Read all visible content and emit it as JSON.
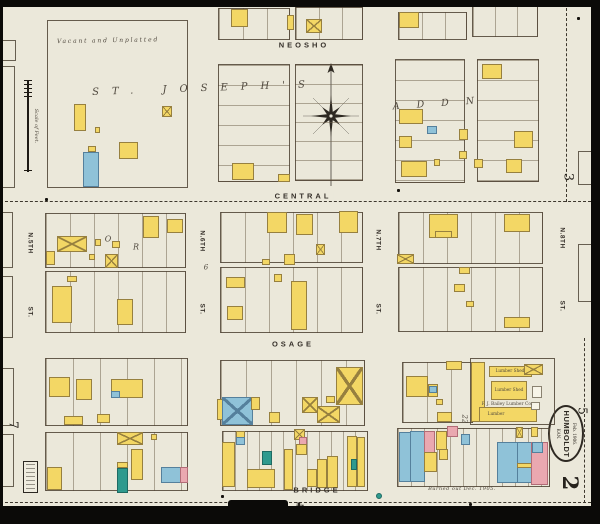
{
  "map": {
    "colors": {
      "paper": "#ebe8da",
      "block_line": "#4e4232",
      "yellow": "#f3d765",
      "yellow_line": "#97803f",
      "blue": "#8fc2d8",
      "blue_line": "#55809c",
      "teal": "#2f9a8e",
      "teal_line": "#1e6b63",
      "pink": "#eaa8b0",
      "pink_line": "#b26c77",
      "white": "#f7f4e8",
      "white_line": "#8a8271",
      "ink": "#36302a"
    },
    "stamp": {
      "date": "Feb. 1906.",
      "city": "HUMBOLDT",
      "state": "KAN."
    },
    "scale_label": "Scale of Feet.",
    "street_labels": [
      {
        "t": "NEOSHO",
        "x": 304,
        "y": 46,
        "r": 0,
        "s": 7.5,
        "ls": 3
      },
      {
        "t": "CENTRAL",
        "x": 303,
        "y": 197,
        "r": 0,
        "s": 7.5,
        "ls": 3,
        "bg": 1
      },
      {
        "t": "OSAGE",
        "x": 293,
        "y": 345,
        "r": 0,
        "s": 7.5,
        "ls": 3
      },
      {
        "t": "BRIDGE",
        "x": 317,
        "y": 491,
        "r": 0,
        "s": 7.5,
        "ls": 3
      },
      {
        "t": "N.5TH",
        "x": 30,
        "y": 243,
        "r": 90,
        "s": 6.5,
        "ls": 0.5
      },
      {
        "t": "ST.",
        "x": 30,
        "y": 312,
        "r": 90,
        "s": 6.5,
        "ls": 0.5
      },
      {
        "t": "N.6TH",
        "x": 202,
        "y": 241,
        "r": 90,
        "s": 6.5,
        "ls": 0.5
      },
      {
        "t": "ST.",
        "x": 202,
        "y": 309,
        "r": 90,
        "s": 6.5,
        "ls": 0.5
      },
      {
        "t": "N.7TH",
        "x": 378,
        "y": 240,
        "r": 90,
        "s": 6.5,
        "ls": 0.5
      },
      {
        "t": "ST.",
        "x": 378,
        "y": 309,
        "r": 90,
        "s": 6.5,
        "ls": 0.5
      },
      {
        "t": "N.8TH",
        "x": 562,
        "y": 238,
        "r": 90,
        "s": 6.5,
        "ls": 0.5
      },
      {
        "t": "ST.",
        "x": 562,
        "y": 306,
        "r": 90,
        "s": 6.5,
        "ls": 0.5
      }
    ],
    "annotations": [
      {
        "t": "Vacant and Unplatted",
        "x": 108,
        "y": 41,
        "r": -1,
        "s": 6,
        "ls": 1.8,
        "i": 1
      },
      {
        "t": "ST. JOSEPH'S",
        "x": 205,
        "y": 89,
        "r": -2,
        "s": 10,
        "ls": 13,
        "i": 1
      },
      {
        "t": "ADDN",
        "x": 442,
        "y": 104,
        "r": -4,
        "s": 9.5,
        "ls": 17,
        "i": 1
      },
      {
        "t": "O",
        "x": 108,
        "y": 240,
        "r": 0,
        "s": 8,
        "ls": 0,
        "i": 1
      },
      {
        "t": "R",
        "x": 136,
        "y": 248,
        "r": 0,
        "s": 8,
        "ls": 0,
        "i": 1
      },
      {
        "t": "6",
        "x": 206,
        "y": 268,
        "r": 0,
        "s": 7,
        "ls": 0,
        "i": 1
      },
      {
        "t": "Lumber Shed",
        "x": 510,
        "y": 371,
        "r": 0,
        "s": 4.2,
        "ls": 0,
        "i": 0
      },
      {
        "t": "Lumber Shed",
        "x": 509,
        "y": 390,
        "r": 0,
        "s": 4.2,
        "ls": 0,
        "i": 0
      },
      {
        "t": "F. J. Bailey Lumber Co.",
        "x": 507,
        "y": 404,
        "r": 0,
        "s": 4.4,
        "ls": 0,
        "i": 0
      },
      {
        "t": "Lumber",
        "x": 496,
        "y": 414,
        "r": 0,
        "s": 4.2,
        "ls": 0,
        "i": 0
      },
      {
        "t": "Burned out Dec. 1905.",
        "x": 462,
        "y": 489,
        "r": 0,
        "s": 5,
        "ls": 0.5,
        "i": 1
      },
      {
        "t": "22",
        "x": 464,
        "y": 419,
        "r": 90,
        "s": 7,
        "ls": 0,
        "i": 1
      }
    ],
    "page_numbers": [
      {
        "t": "3",
        "x": 567,
        "y": 177,
        "r": 90,
        "s": 13,
        "b": 0
      },
      {
        "t": "5",
        "x": 581,
        "y": 411,
        "r": 90,
        "s": 12,
        "b": 0
      },
      {
        "t": "7",
        "x": 12,
        "y": 425,
        "r": 90,
        "s": 12,
        "b": 0
      },
      {
        "t": "2",
        "x": 567,
        "y": 483,
        "r": 90,
        "s": 21,
        "b": 1
      },
      {
        "t": "4",
        "x": 300,
        "y": 505,
        "r": 180,
        "s": 12,
        "b": 1
      }
    ],
    "blocks": [
      [
        47,
        20,
        141,
        168,
        "",
        0
      ],
      [
        218,
        8,
        72,
        32,
        "v",
        24
      ],
      [
        295,
        7,
        68,
        33,
        "v",
        23
      ],
      [
        398,
        12,
        69,
        28,
        "v",
        23
      ],
      [
        472,
        6,
        66,
        31,
        "v",
        22
      ],
      [
        218,
        64,
        72,
        118,
        "h",
        20
      ],
      [
        295,
        64,
        68,
        117,
        "h",
        19
      ],
      [
        395,
        59,
        70,
        124,
        "h",
        20
      ],
      [
        477,
        59,
        62,
        123,
        "h",
        20
      ],
      [
        45,
        213,
        141,
        55,
        "v",
        24
      ],
      [
        45,
        271,
        141,
        62,
        "v",
        24
      ],
      [
        220,
        212,
        143,
        51,
        "v",
        24
      ],
      [
        220,
        267,
        143,
        66,
        "v",
        24
      ],
      [
        398,
        212,
        145,
        52,
        "v",
        24
      ],
      [
        398,
        267,
        145,
        65,
        "v",
        24
      ],
      [
        45,
        358,
        143,
        68,
        "v",
        27
      ],
      [
        45,
        432,
        143,
        59,
        "v",
        27
      ],
      [
        220,
        360,
        145,
        66,
        "v",
        25
      ],
      [
        222,
        431,
        146,
        60,
        "v",
        12
      ],
      [
        402,
        362,
        71,
        61,
        "v",
        24
      ],
      [
        470,
        358,
        85,
        67,
        "",
        0
      ],
      [
        397,
        428,
        153,
        59,
        "v",
        13
      ]
    ],
    "buildings": [
      [
        74,
        104,
        12,
        27,
        "y"
      ],
      [
        88,
        146,
        8,
        6,
        "y"
      ],
      [
        83,
        152,
        16,
        35,
        "b"
      ],
      [
        119,
        142,
        19,
        17,
        "y"
      ],
      [
        162,
        106,
        10,
        11,
        "y",
        "x"
      ],
      [
        95,
        127,
        5,
        6,
        "y"
      ],
      [
        231,
        9,
        17,
        18,
        "y"
      ],
      [
        287,
        15,
        7,
        15,
        "y"
      ],
      [
        306,
        19,
        16,
        14,
        "y",
        "x"
      ],
      [
        399,
        12,
        20,
        16,
        "y"
      ],
      [
        442,
        1,
        11,
        6,
        "y"
      ],
      [
        514,
        0,
        13,
        5,
        "y"
      ],
      [
        232,
        163,
        22,
        17,
        "y"
      ],
      [
        278,
        174,
        12,
        8,
        "y"
      ],
      [
        482,
        64,
        20,
        15,
        "y"
      ],
      [
        399,
        109,
        24,
        15,
        "y"
      ],
      [
        427,
        126,
        10,
        8,
        "b"
      ],
      [
        459,
        129,
        9,
        11,
        "y"
      ],
      [
        399,
        136,
        13,
        12,
        "y"
      ],
      [
        514,
        131,
        19,
        17,
        "y"
      ],
      [
        401,
        161,
        26,
        16,
        "y"
      ],
      [
        506,
        159,
        16,
        14,
        "y"
      ],
      [
        459,
        151,
        8,
        8,
        "y"
      ],
      [
        474,
        159,
        9,
        9,
        "y"
      ],
      [
        434,
        159,
        6,
        7,
        "y"
      ],
      [
        57,
        236,
        30,
        16,
        "y",
        "x"
      ],
      [
        46,
        251,
        9,
        14,
        "y"
      ],
      [
        95,
        239,
        6,
        7,
        "y"
      ],
      [
        112,
        241,
        8,
        7,
        "y"
      ],
      [
        105,
        254,
        13,
        14,
        "y",
        "x"
      ],
      [
        89,
        254,
        6,
        6,
        "y"
      ],
      [
        143,
        216,
        16,
        22,
        "y"
      ],
      [
        167,
        219,
        16,
        14,
        "y"
      ],
      [
        67,
        276,
        10,
        6,
        "y"
      ],
      [
        52,
        286,
        20,
        37,
        "y"
      ],
      [
        117,
        299,
        16,
        26,
        "y"
      ],
      [
        267,
        212,
        20,
        21,
        "y"
      ],
      [
        296,
        214,
        17,
        21,
        "y"
      ],
      [
        339,
        211,
        19,
        22,
        "y"
      ],
      [
        316,
        244,
        9,
        11,
        "y",
        "x"
      ],
      [
        284,
        254,
        11,
        11,
        "y"
      ],
      [
        262,
        259,
        8,
        6,
        "y"
      ],
      [
        226,
        277,
        19,
        11,
        "y"
      ],
      [
        227,
        306,
        16,
        14,
        "y"
      ],
      [
        291,
        281,
        16,
        49,
        "y"
      ],
      [
        274,
        274,
        8,
        8,
        "y"
      ],
      [
        429,
        214,
        29,
        24,
        "y"
      ],
      [
        504,
        214,
        26,
        18,
        "y"
      ],
      [
        397,
        254,
        17,
        10,
        "y",
        "x"
      ],
      [
        435,
        231,
        17,
        7,
        "y"
      ],
      [
        459,
        267,
        11,
        7,
        "y"
      ],
      [
        454,
        284,
        11,
        8,
        "y"
      ],
      [
        504,
        317,
        26,
        11,
        "y"
      ],
      [
        466,
        301,
        8,
        6,
        "y"
      ],
      [
        49,
        377,
        21,
        20,
        "y"
      ],
      [
        76,
        379,
        16,
        21,
        "y"
      ],
      [
        111,
        379,
        32,
        19,
        "y"
      ],
      [
        111,
        391,
        9,
        7,
        "b"
      ],
      [
        64,
        416,
        19,
        9,
        "y"
      ],
      [
        97,
        414,
        13,
        9,
        "y"
      ],
      [
        117,
        432,
        26,
        13,
        "y",
        "x"
      ],
      [
        151,
        434,
        6,
        6,
        "y"
      ],
      [
        47,
        467,
        15,
        23,
        "y"
      ],
      [
        117,
        462,
        11,
        6,
        "y"
      ],
      [
        117,
        468,
        11,
        25,
        "t"
      ],
      [
        131,
        449,
        12,
        31,
        "y"
      ],
      [
        161,
        467,
        27,
        16,
        "b"
      ],
      [
        180,
        467,
        8,
        16,
        "p"
      ],
      [
        217,
        399,
        8,
        21,
        "y"
      ],
      [
        222,
        397,
        31,
        28,
        "b",
        "x"
      ],
      [
        251,
        397,
        9,
        13,
        "y"
      ],
      [
        269,
        412,
        11,
        11,
        "y"
      ],
      [
        302,
        397,
        16,
        16,
        "y",
        "x"
      ],
      [
        317,
        406,
        23,
        17,
        "y",
        "x"
      ],
      [
        336,
        367,
        27,
        38,
        "y",
        "x"
      ],
      [
        326,
        396,
        9,
        7,
        "y"
      ],
      [
        222,
        442,
        13,
        45,
        "y"
      ],
      [
        236,
        431,
        9,
        7,
        "y"
      ],
      [
        236,
        437,
        9,
        8,
        "b"
      ],
      [
        247,
        469,
        28,
        19,
        "y"
      ],
      [
        262,
        451,
        10,
        14,
        "t"
      ],
      [
        284,
        449,
        9,
        41,
        "y"
      ],
      [
        294,
        429,
        11,
        11,
        "y",
        "x"
      ],
      [
        299,
        437,
        8,
        10,
        "p"
      ],
      [
        296,
        444,
        11,
        11,
        "y"
      ],
      [
        307,
        469,
        10,
        18,
        "y"
      ],
      [
        317,
        459,
        10,
        29,
        "y"
      ],
      [
        327,
        456,
        11,
        32,
        "y"
      ],
      [
        347,
        436,
        10,
        51,
        "y"
      ],
      [
        351,
        459,
        6,
        11,
        "t"
      ],
      [
        357,
        437,
        8,
        50,
        "y"
      ],
      [
        406,
        376,
        22,
        21,
        "y"
      ],
      [
        428,
        384,
        10,
        13,
        "y"
      ],
      [
        429,
        386,
        8,
        7,
        "b"
      ],
      [
        436,
        399,
        7,
        6,
        "y"
      ],
      [
        437,
        412,
        15,
        10,
        "y"
      ],
      [
        446,
        361,
        16,
        9,
        "y"
      ],
      [
        471,
        362,
        14,
        60,
        "y"
      ],
      [
        489,
        366,
        43,
        11,
        "y"
      ],
      [
        524,
        364,
        19,
        11,
        "y",
        "x"
      ],
      [
        491,
        381,
        36,
        19,
        "y"
      ],
      [
        532,
        386,
        10,
        12,
        "w"
      ],
      [
        479,
        407,
        58,
        15,
        "y"
      ],
      [
        531,
        402,
        9,
        8,
        "w"
      ],
      [
        399,
        432,
        12,
        50,
        "b"
      ],
      [
        410,
        431,
        15,
        51,
        "b"
      ],
      [
        424,
        431,
        11,
        22,
        "p"
      ],
      [
        424,
        452,
        13,
        20,
        "y"
      ],
      [
        436,
        431,
        11,
        19,
        "y"
      ],
      [
        447,
        426,
        11,
        11,
        "p"
      ],
      [
        461,
        434,
        9,
        11,
        "b"
      ],
      [
        439,
        449,
        9,
        11,
        "y"
      ],
      [
        497,
        442,
        21,
        41,
        "b"
      ],
      [
        517,
        442,
        15,
        41,
        "b"
      ],
      [
        517,
        463,
        15,
        5,
        "y"
      ],
      [
        531,
        442,
        17,
        43,
        "p"
      ],
      [
        532,
        442,
        11,
        11,
        "b"
      ],
      [
        516,
        427,
        7,
        11,
        "y",
        "x"
      ],
      [
        531,
        427,
        7,
        10,
        "y"
      ]
    ],
    "edge_parcels": [
      [
        1,
        40,
        15,
        21
      ],
      [
        1,
        66,
        14,
        122
      ],
      [
        0,
        212,
        13,
        56
      ],
      [
        0,
        276,
        13,
        62
      ],
      [
        0,
        368,
        14,
        58
      ],
      [
        0,
        434,
        14,
        53
      ],
      [
        578,
        151,
        18,
        34
      ],
      [
        578,
        244,
        18,
        58
      ]
    ],
    "match_lines": [
      {
        "d": "h",
        "x": 0,
        "y": 201,
        "l": 591
      },
      {
        "d": "h",
        "x": 0,
        "y": 502,
        "l": 591
      },
      {
        "d": "v",
        "x": 566,
        "y": 8,
        "l": 194
      },
      {
        "d": "v",
        "x": 584,
        "y": 338,
        "l": 165
      }
    ],
    "dots": [
      [
        45,
        198
      ],
      [
        397,
        189
      ],
      [
        577,
        17
      ],
      [
        221,
        495
      ],
      [
        469,
        503
      ]
    ],
    "water_dot": [
      376,
      493
    ],
    "slivers": [
      [
        591,
        52,
        9,
        136
      ],
      [
        591,
        402,
        9,
        86
      ]
    ]
  }
}
